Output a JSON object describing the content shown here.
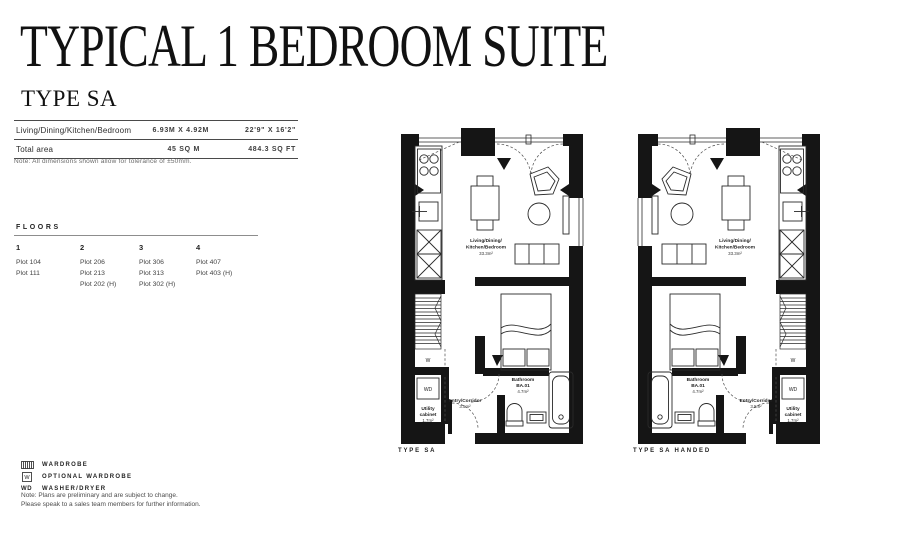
{
  "header": {
    "title": "TYPICAL 1 BEDROOM SUITE",
    "subtitle": "TYPE SA"
  },
  "spec_table": {
    "rows": [
      {
        "label": "Living/Dining/Kitchen/Bedroom",
        "metric": "6.93M X 4.92M",
        "imperial": "22'9\" X 16'2\""
      },
      {
        "label": "Total area",
        "metric": "45 SQ M",
        "imperial": "484.3 SQ FT"
      }
    ],
    "note": "Note: All dimensions shown allow for tolerance of ±50mm."
  },
  "floors": {
    "heading": "FLOORS",
    "columns": [
      {
        "number": "1",
        "plots": [
          "Plot 104",
          "Plot 111"
        ]
      },
      {
        "number": "2",
        "plots": [
          "Plot 206",
          "Plot 213",
          "Plot 202 (H)"
        ]
      },
      {
        "number": "3",
        "plots": [
          "Plot 306",
          "Plot 313",
          "Plot 302 (H)"
        ]
      },
      {
        "number": "4",
        "plots": [
          "Plot 407",
          "Plot 403 (H)"
        ]
      }
    ]
  },
  "legend": {
    "optional_symbol": "W",
    "washer_abbrev": "WD",
    "items": [
      {
        "label": "WARDROBE"
      },
      {
        "label": "OPTIONAL WARDROBE"
      },
      {
        "label": "WASHER/DRYER"
      }
    ]
  },
  "footer_note": {
    "line1": "Note: Plans are preliminary and are subject to change.",
    "line2": "Please speak to a sales team members for further information."
  },
  "plans": [
    {
      "name": "TYPE SA",
      "labels": {
        "living1": "Living/Dining/",
        "living2": "Kitchen/Bedroom",
        "living3": "33.3m²",
        "bath1": "Bathroom",
        "bath2": "BA.01",
        "bath3": "4.7m²",
        "entry1": "Entry/Corridor",
        "entry2": "3.5m²",
        "utility1": "Utility",
        "utility2": "cabinet",
        "utility3": "1.7m²",
        "wardrobe": "W",
        "washer": "WD"
      }
    },
    {
      "name": "TYPE SA HANDED",
      "labels": {
        "living1": "Living/Dining/",
        "living2": "Kitchen/Bedroom",
        "living3": "33.3m²",
        "bath1": "Bathroom",
        "bath2": "BA.01",
        "bath3": "4.7m²",
        "entry1": "Entry/Corridor",
        "entry2": "3.5m²",
        "utility1": "Utility",
        "utility2": "cabinet",
        "utility3": "1.7m²",
        "wardrobe": "W",
        "washer": "WD"
      }
    }
  ]
}
